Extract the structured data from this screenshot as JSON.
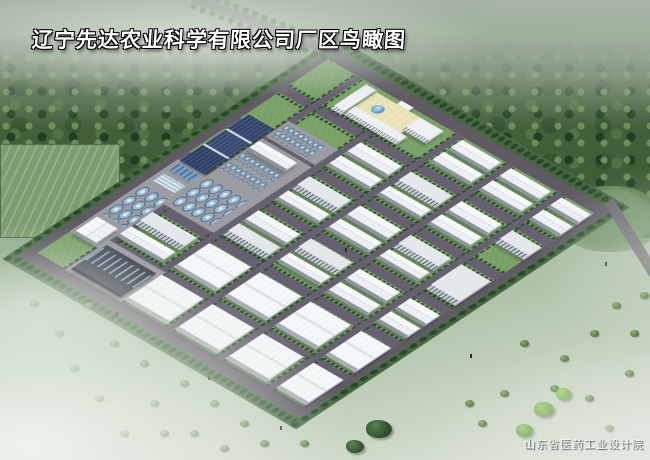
{
  "title": {
    "text": "辽宁先达农业科学有限公司厂区鸟瞰图"
  },
  "credit": {
    "text": "山东省医药工业设计院"
  },
  "palette": {
    "forest": "#3f5d3a",
    "field": "#9db79a",
    "mist": "#e6ebe2",
    "road": "#5f5a64",
    "lawn": "#79a066",
    "roof_white": "#f4f6f8",
    "wall_grey": "#98a0a8",
    "solar_panel": "#33466e",
    "tank_silver": "#9dbcd4",
    "courtyard": "#e9e2b6",
    "pond": "#5f9fd0",
    "title_text": "#ffffff"
  },
  "scene": {
    "site_label": "factory-campus-aerial-view",
    "ring_road_width": 13,
    "v_roads": [
      64,
      158,
      252,
      346,
      440
    ],
    "u_roads": [
      62,
      124,
      186,
      248,
      310
    ],
    "buildings": [
      {
        "kind": "paved",
        "u": 13,
        "v": 196,
        "w": 53,
        "h": 132,
        "name": "paved-apron"
      },
      {
        "kind": "paved",
        "u": 66,
        "v": 96,
        "w": 92,
        "h": 28,
        "name": "paved-apron"
      },
      {
        "kind": "paved",
        "u": 66,
        "v": 128,
        "w": 92,
        "h": 120,
        "name": "paved-apron"
      },
      {
        "kind": "paved",
        "u": 66,
        "v": 314,
        "w": 104,
        "h": 54,
        "name": "paved-apron"
      },
      {
        "kind": "solar",
        "u": 16,
        "v": 112,
        "w": 46,
        "h": 84,
        "name": "solar-panel-array"
      },
      {
        "kind": "bluroof",
        "u": 20,
        "v": 200,
        "w": 40,
        "h": 14,
        "name": "solar-heater-shed"
      },
      {
        "kind": "glass",
        "u": 20,
        "v": 218,
        "w": 40,
        "h": 16,
        "name": "greenhouse"
      },
      {
        "kind": "tanks-lg",
        "u": 18,
        "v": 240,
        "w": 44,
        "h": 52,
        "name": "storage-tank-group"
      },
      {
        "kind": "wh-v",
        "u": 18,
        "v": 298,
        "w": 40,
        "h": 30,
        "name": "warehouse"
      },
      {
        "kind": "tanks-sm",
        "u": 70,
        "v": 100,
        "w": 70,
        "h": 22,
        "name": "fermenter-tank-rows"
      },
      {
        "kind": "wh-u",
        "u": 66,
        "v": 132,
        "w": 72,
        "h": 16,
        "name": "workshop"
      },
      {
        "kind": "tanks-sm",
        "u": 68,
        "v": 152,
        "w": 74,
        "h": 13,
        "name": "fermenter-tank-rows"
      },
      {
        "kind": "tanks-sm",
        "u": 68,
        "v": 169,
        "w": 74,
        "h": 13,
        "name": "fermenter-tank-rows"
      },
      {
        "kind": "tanks-lg",
        "u": 70,
        "v": 196,
        "w": 74,
        "h": 48,
        "name": "storage-tank-group"
      },
      {
        "kind": "flat",
        "u": 66,
        "v": 262,
        "w": 84,
        "h": 22,
        "name": "production-building"
      },
      {
        "kind": "wh-u",
        "u": 66,
        "v": 288,
        "w": 84,
        "h": 18,
        "name": "warehouse"
      },
      {
        "kind": "chem",
        "u": 70,
        "v": 320,
        "w": 92,
        "h": 44,
        "name": "chemical-process-plant"
      },
      {
        "kind": "court",
        "u": 110,
        "v": 18,
        "w": 86,
        "h": 40,
        "name": "office-courtyard"
      },
      {
        "kind": "office",
        "u": 88,
        "v": 16,
        "w": 20,
        "h": 44,
        "name": "office-building"
      },
      {
        "kind": "office",
        "u": 110,
        "v": 44,
        "w": 98,
        "h": 14,
        "name": "office-building"
      },
      {
        "kind": "office",
        "u": 192,
        "v": 18,
        "w": 44,
        "h": 22,
        "name": "office-building"
      },
      {
        "kind": "pond",
        "u": 128,
        "v": 28,
        "w": 18,
        "h": 12,
        "name": "fountain-pond"
      },
      {
        "kind": "gate",
        "u": 146,
        "v": 12,
        "w": 26,
        "h": 6,
        "name": "factory-gate"
      },
      {
        "kind": "wh-u",
        "u": 169,
        "v": 76,
        "w": 78,
        "h": 20,
        "name": "warehouse"
      },
      {
        "kind": "wh-u",
        "u": 169,
        "v": 100,
        "w": 78,
        "h": 18,
        "name": "warehouse"
      },
      {
        "kind": "flat",
        "u": 169,
        "v": 138,
        "w": 78,
        "h": 22,
        "name": "production-building"
      },
      {
        "kind": "wh-u",
        "u": 169,
        "v": 164,
        "w": 78,
        "h": 16,
        "name": "warehouse"
      },
      {
        "kind": "wh-u",
        "u": 169,
        "v": 200,
        "w": 78,
        "h": 20,
        "name": "warehouse"
      },
      {
        "kind": "flat",
        "u": 169,
        "v": 224,
        "w": 78,
        "h": 20,
        "name": "production-building"
      },
      {
        "kind": "bigshed",
        "u": 169,
        "v": 260,
        "w": 78,
        "h": 44,
        "name": "large-workshop"
      },
      {
        "kind": "bigshed",
        "u": 169,
        "v": 318,
        "w": 78,
        "h": 46,
        "name": "large-workshop"
      },
      {
        "kind": "wh-u",
        "u": 266,
        "v": 16,
        "w": 74,
        "h": 18,
        "name": "warehouse"
      },
      {
        "kind": "wh-u",
        "u": 266,
        "v": 38,
        "w": 74,
        "h": 18,
        "name": "warehouse"
      },
      {
        "kind": "flat",
        "u": 263,
        "v": 76,
        "w": 78,
        "h": 22,
        "name": "production-building"
      },
      {
        "kind": "wh-u",
        "u": 263,
        "v": 102,
        "w": 78,
        "h": 16,
        "name": "warehouse"
      },
      {
        "kind": "wh-u",
        "u": 263,
        "v": 138,
        "w": 78,
        "h": 20,
        "name": "warehouse"
      },
      {
        "kind": "wh-u",
        "u": 263,
        "v": 162,
        "w": 78,
        "h": 18,
        "name": "warehouse"
      },
      {
        "kind": "flat",
        "u": 263,
        "v": 198,
        "w": 78,
        "h": 22,
        "name": "production-building"
      },
      {
        "kind": "wh-u",
        "u": 263,
        "v": 224,
        "w": 78,
        "h": 16,
        "name": "warehouse"
      },
      {
        "kind": "bigshed",
        "u": 263,
        "v": 260,
        "w": 78,
        "h": 44,
        "name": "large-workshop"
      },
      {
        "kind": "bigshed",
        "u": 263,
        "v": 318,
        "w": 78,
        "h": 46,
        "name": "large-workshop"
      },
      {
        "kind": "wh-u",
        "u": 357,
        "v": 16,
        "w": 76,
        "h": 18,
        "name": "warehouse"
      },
      {
        "kind": "wh-u",
        "u": 357,
        "v": 38,
        "w": 76,
        "h": 18,
        "name": "warehouse"
      },
      {
        "kind": "wh-u",
        "u": 357,
        "v": 76,
        "w": 76,
        "h": 20,
        "name": "warehouse"
      },
      {
        "kind": "wh-u",
        "u": 357,
        "v": 100,
        "w": 76,
        "h": 18,
        "name": "warehouse"
      },
      {
        "kind": "flat",
        "u": 357,
        "v": 138,
        "w": 76,
        "h": 22,
        "name": "production-building"
      },
      {
        "kind": "wh-u",
        "u": 357,
        "v": 164,
        "w": 76,
        "h": 16,
        "name": "warehouse"
      },
      {
        "kind": "wh-u",
        "u": 357,
        "v": 200,
        "w": 76,
        "h": 20,
        "name": "warehouse"
      },
      {
        "kind": "wh-u",
        "u": 357,
        "v": 224,
        "w": 76,
        "h": 18,
        "name": "warehouse"
      },
      {
        "kind": "bigshed",
        "u": 357,
        "v": 260,
        "w": 76,
        "h": 44,
        "name": "large-workshop"
      },
      {
        "kind": "bigshed",
        "u": 357,
        "v": 318,
        "w": 76,
        "h": 46,
        "name": "large-workshop"
      },
      {
        "kind": "wh-u",
        "u": 451,
        "v": 16,
        "w": 56,
        "h": 18,
        "name": "warehouse"
      },
      {
        "kind": "wh-u",
        "u": 451,
        "v": 38,
        "w": 56,
        "h": 18,
        "name": "warehouse"
      },
      {
        "kind": "flat",
        "u": 451,
        "v": 76,
        "w": 56,
        "h": 22,
        "name": "production-building"
      },
      {
        "kind": "flat",
        "u": 451,
        "v": 138,
        "w": 56,
        "h": 44,
        "name": "production-building"
      },
      {
        "kind": "wh-u",
        "u": 451,
        "v": 200,
        "w": 56,
        "h": 20,
        "name": "warehouse"
      },
      {
        "kind": "wh-u",
        "u": 451,
        "v": 224,
        "w": 56,
        "h": 18,
        "name": "warehouse"
      },
      {
        "kind": "bigshed",
        "u": 451,
        "v": 260,
        "w": 56,
        "h": 44,
        "name": "large-workshop"
      },
      {
        "kind": "bigshed",
        "u": 451,
        "v": 318,
        "w": 56,
        "h": 46,
        "name": "large-workshop"
      }
    ]
  }
}
